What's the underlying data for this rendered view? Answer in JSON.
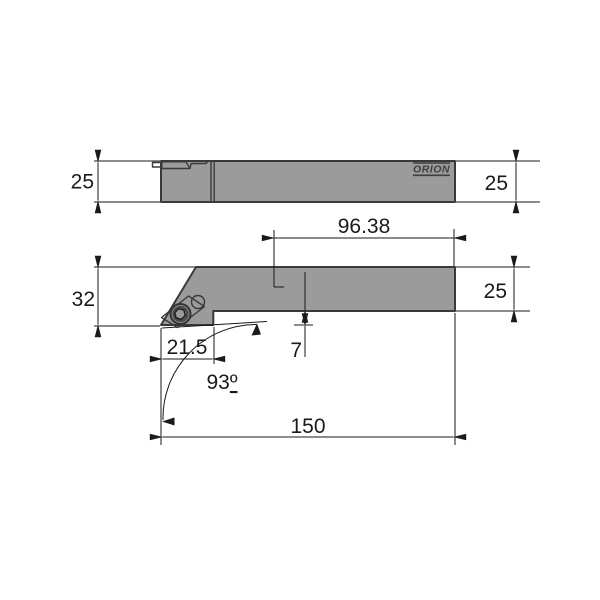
{
  "drawing": {
    "brand_label": "ORION",
    "colors": {
      "background": "#ffffff",
      "body": "#9b9b9b",
      "pocket": "#bcbcbc",
      "insert": "#b1b1b1",
      "protrusion": "#c6c6c6",
      "screw": "#8f8f8f",
      "screw_socket": "#9a9a9a",
      "outline": "#3a3a3a",
      "line": "#1a1a1a",
      "logo": "#3f3f3f"
    },
    "dimensions": {
      "top_height_left": "25",
      "top_height_right": "25",
      "front_total_height": "32",
      "front_tip_to_end": "96.38",
      "front_shank_height": "25",
      "front_head_length": "21.5",
      "front_tip_drop": "7",
      "front_lead_angle": "93",
      "front_lead_angle_symbol": "º",
      "front_overall_length": "150"
    }
  }
}
